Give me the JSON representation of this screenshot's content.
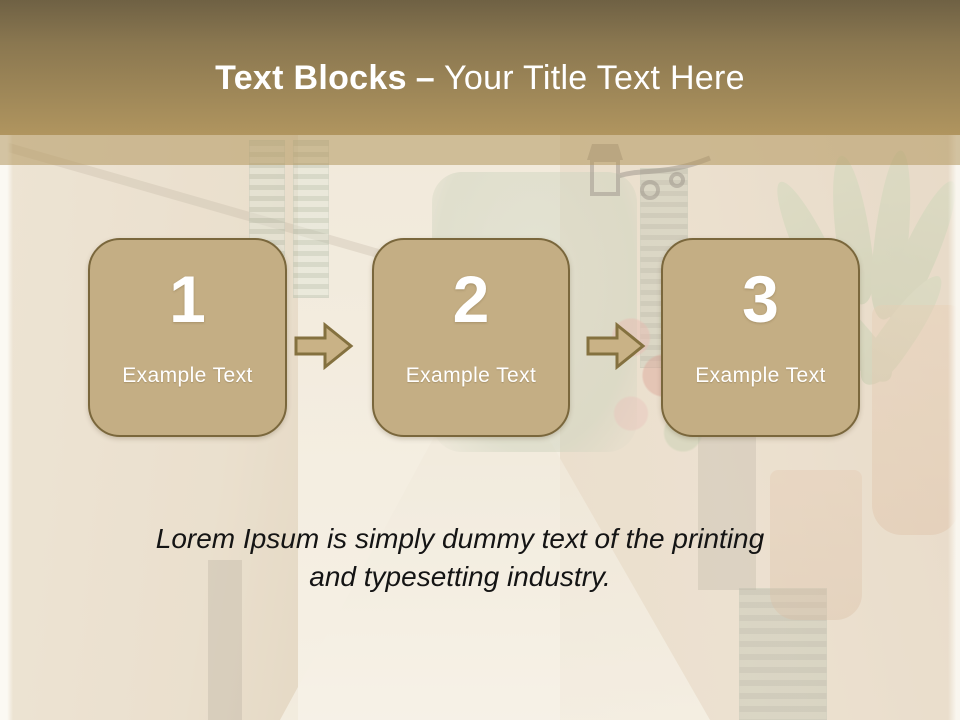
{
  "slide": {
    "title": {
      "bold": "Text Blocks",
      "dash": "–",
      "rest": "Your Title Text Here"
    },
    "steps": [
      {
        "number": "1",
        "label": "Example Text"
      },
      {
        "number": "2",
        "label": "Example Text"
      },
      {
        "number": "3",
        "label": "Example Text"
      }
    ],
    "paragraph": {
      "lines": [
        "Lorem Ipsum is simply dummy text of the printing",
        "and typesetting industry."
      ]
    },
    "colors": {
      "header_top": "#6f6144",
      "header_bottom": "#b0955f",
      "box_fill": "#c4ae84",
      "box_border": "#7a673c",
      "arrow_fill": "#c9b286",
      "arrow_stroke": "#84713f",
      "title_text": "#ffffff",
      "body_text": "#141414"
    }
  }
}
